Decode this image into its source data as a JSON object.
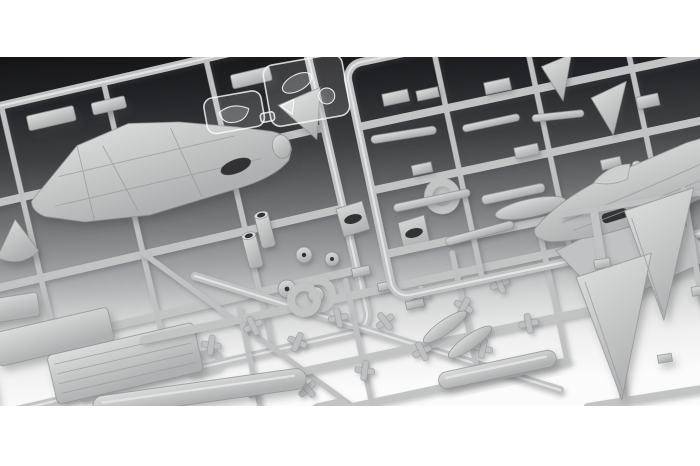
{
  "scene": {
    "type": "product-photo",
    "subject": "Unassembled plastic scale-model aircraft kit: light gray injection-molded sprues and two clear canopy sprues on a studio gradient background, dark at top fading to white at bottom, with white letterbox bands above and below",
    "letterbox": {
      "top_band": "white",
      "bottom_band": "white"
    }
  },
  "palette": {
    "letterbox": "#ffffff",
    "background_top": "#141416",
    "background_middle": "#78797b",
    "background_bottom": "#fbfbfb",
    "plastic_base": "#c5c7c7",
    "plastic_highlight": "#dedfe0",
    "plastic_shadow": "#8e9091",
    "clear_plastic_edge": "#f5f7f8",
    "cockpit_opening": "#313235"
  },
  "objects": {
    "sprues": [
      {
        "name": "gray-sprue-left",
        "contents": "upper fuselage shell, nose cone, hatch panels, ribbed airbrake panel, small doors"
      },
      {
        "name": "clear-sprue-small",
        "contents": "windscreen part"
      },
      {
        "name": "clear-sprue-large",
        "contents": "canopy and clear parts"
      },
      {
        "name": "gray-sprue-top-right",
        "contents": "missiles, stores, pylons, fins, drop-tank half, strut pair, gate ring"
      },
      {
        "name": "gray-sprue-right",
        "contents": "fuselage side half with canopy hump, wing plate"
      },
      {
        "name": "gray-sprue-bottom-right",
        "contents": "two delta wing / fin panels"
      },
      {
        "name": "gray-sprue-bottom-center",
        "contents": "landing-gear parts, wheel discs, exhaust tubes, intake funnels, external fuel tank, tail pods, gate rings"
      }
    ]
  }
}
